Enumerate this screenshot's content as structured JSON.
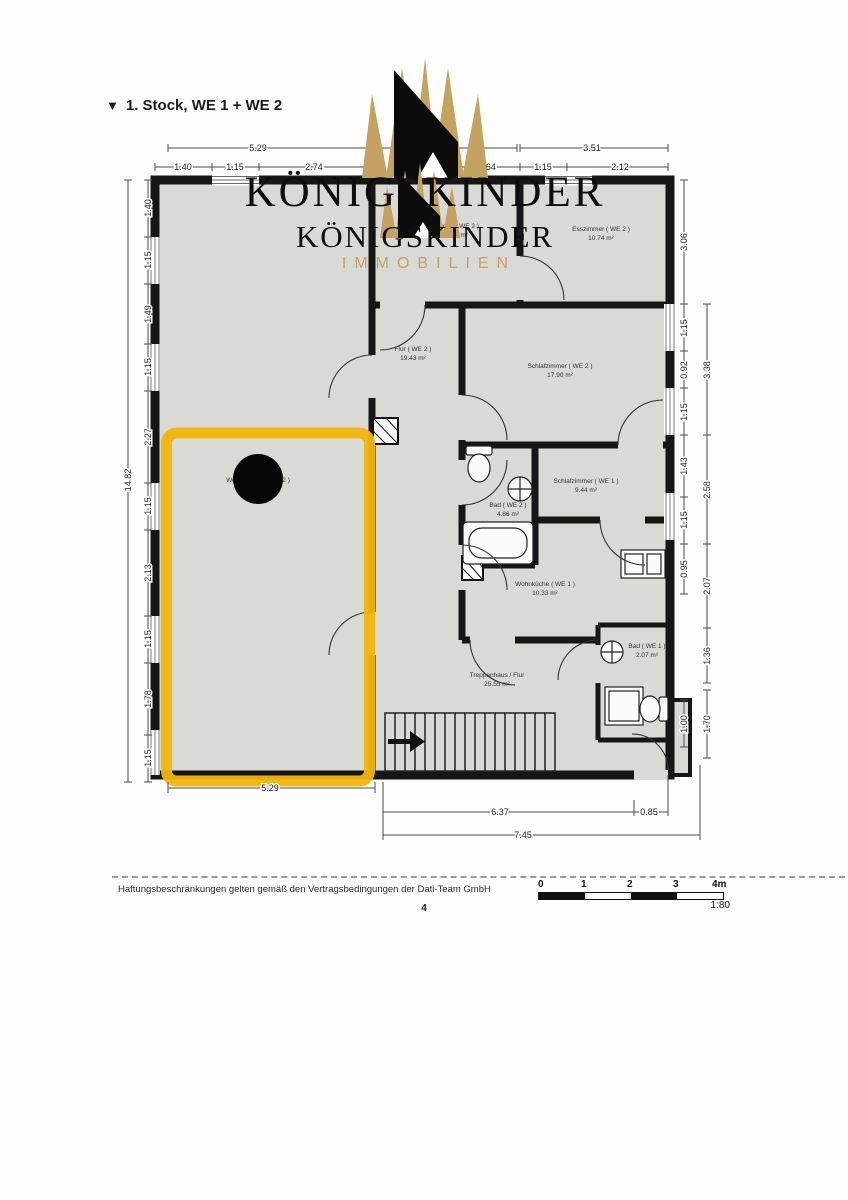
{
  "page": {
    "title_marker": "▼",
    "title": "1. Stock, WE 1 + WE 2",
    "page_number": "4",
    "disclaimer": "Haftungsbeschränkungen gelten gemäß den Vertragsbedingungen der Dati-Team GmbH"
  },
  "watermark": {
    "brand": "KÖNIGSKINDER",
    "brand2": "KÖNIGSKINDER",
    "subtitle": "IMMOBILIEN"
  },
  "scalebar": {
    "labels": [
      "0",
      "1",
      "2",
      "3",
      "4m"
    ],
    "ratio": "1:80"
  },
  "rooms": [
    {
      "label": "Küche ( WE 2 )",
      "area": "5.02 m²"
    },
    {
      "label": "Esszimmer ( WE 2 )",
      "area": "10.74 m²"
    },
    {
      "label": "Flur ( WE 2 )",
      "area": "19.43 m²"
    },
    {
      "label": "Schlafzimmer ( WE 2 )",
      "area": "17.90 m²"
    },
    {
      "label": "Schlafzimmer ( WE 1 )",
      "area": "9.44 m²"
    },
    {
      "label": "Bad ( WE 2 )",
      "area": "4.86 m²"
    },
    {
      "label": "Wohnküche ( WE 1 )",
      "area": "10.33 m²"
    },
    {
      "label": "Bad ( WE 1 )",
      "area": "2.07 m²"
    },
    {
      "label": "Treppenhaus / Flur",
      "area": "25.55 m²"
    },
    {
      "label": "Wohnzimmer ( WE 2 )",
      "area": ""
    }
  ],
  "dims": {
    "top": [
      "5.29",
      "1.40",
      "1.15",
      "2.74",
      "3.12",
      "1.64",
      "3.51",
      "1.15",
      "2.12"
    ],
    "left": [
      "14.82",
      "1.40",
      "1.15",
      "1.49",
      "1.15",
      "2.27",
      "1.15",
      "2.13",
      "1.15",
      "1.78",
      "1.15"
    ],
    "right_inner": [
      "3.06",
      "1.15",
      "0.92",
      "1.15",
      "1.43",
      "1.15",
      "0.95",
      "1.00"
    ],
    "right_outer": [
      "3.38",
      "2.58",
      "2.07",
      "1.36",
      "1.70"
    ],
    "bottom": [
      "5.29",
      "6.37",
      "0.85",
      "7.45"
    ]
  },
  "colors": {
    "highlight": "#f2b50a",
    "gold": "#c3a262",
    "wall": "#161616",
    "room_fill": "#d9d9d6"
  }
}
